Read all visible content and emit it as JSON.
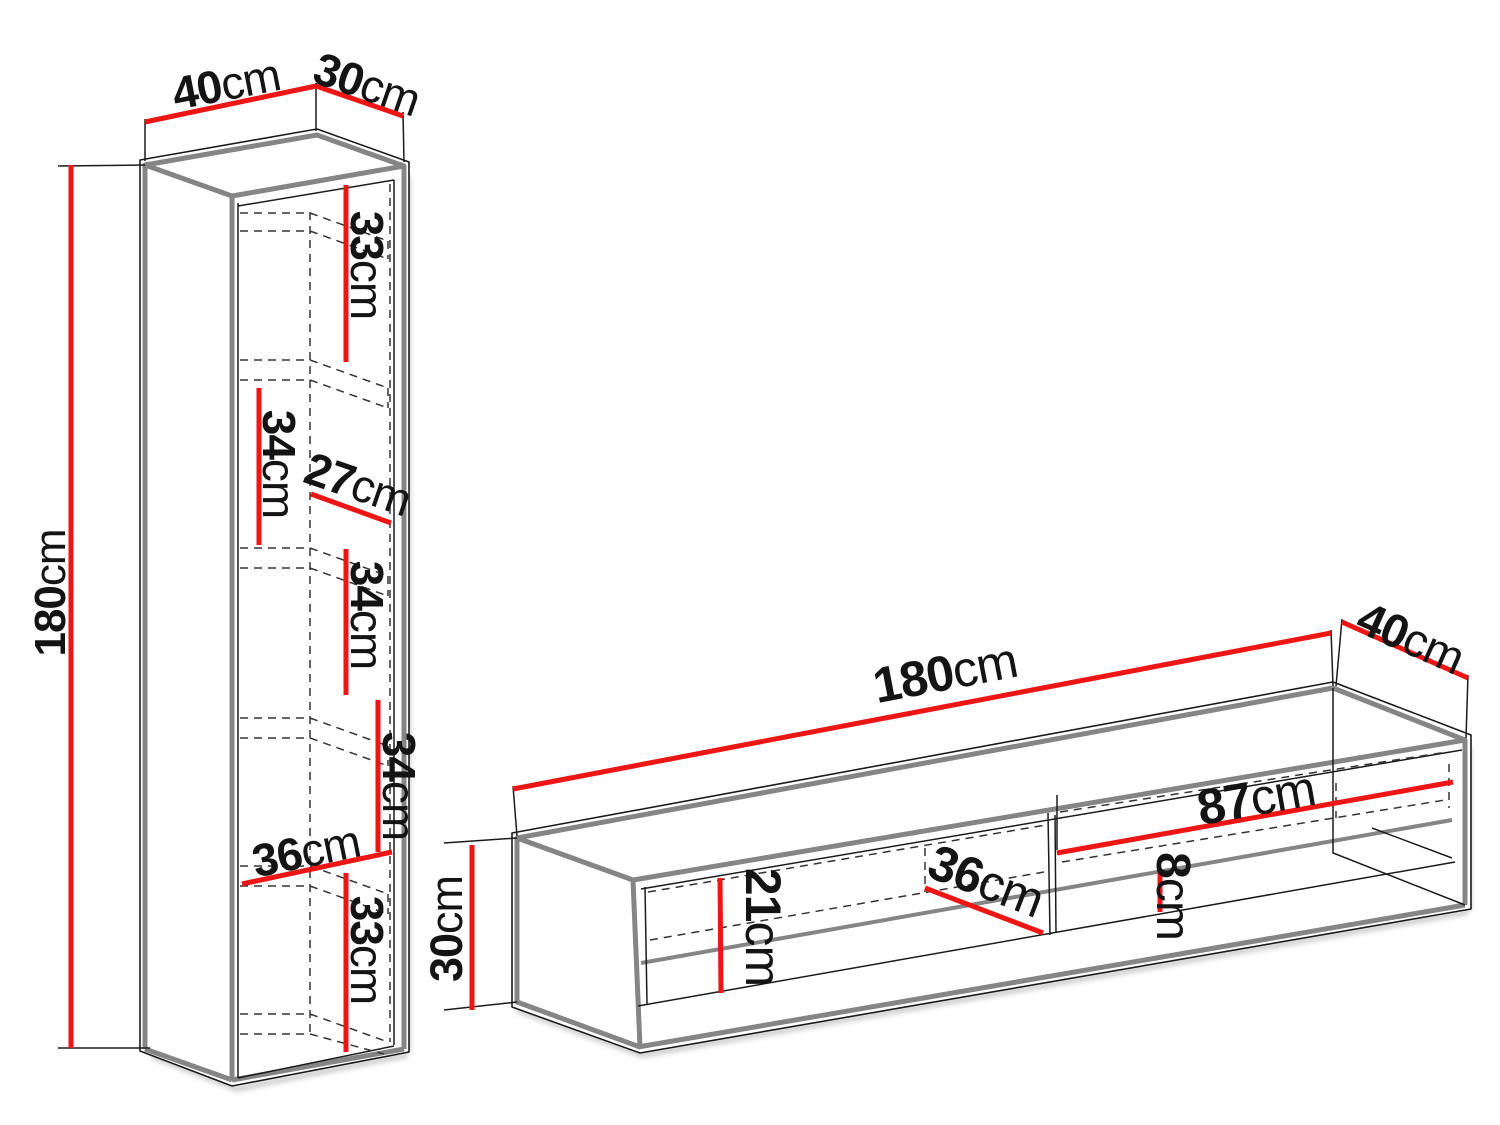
{
  "diagram": {
    "type": "furniture-dimension-drawing",
    "background": "#ffffff",
    "dimension_color": "#ee1515",
    "edge_color": "#858585",
    "outline_color": "#1b1b1b",
    "pieces": [
      {
        "name": "tall wall cabinet",
        "overall": {
          "width": "40cm",
          "depth": "30cm",
          "height": "180cm"
        },
        "internal_dimensions": [
          "33cm",
          "34cm",
          "27cm",
          "34cm",
          "34cm",
          "36cm",
          "33cm"
        ]
      },
      {
        "name": "tv stand",
        "overall": {
          "width": "180cm",
          "depth": "40cm",
          "height": "30cm"
        },
        "internal_dimensions": [
          "21cm",
          "87cm",
          "36cm",
          "8cm"
        ]
      }
    ]
  },
  "labels": {
    "cabinet_width": {
      "value": "40",
      "unit": "cm"
    },
    "cabinet_depth": {
      "value": "30",
      "unit": "cm"
    },
    "cabinet_height": {
      "value": "180",
      "unit": "cm"
    },
    "cabinet_shelf_1": {
      "value": "33",
      "unit": "cm"
    },
    "cabinet_shelf_2": {
      "value": "34",
      "unit": "cm"
    },
    "cabinet_inner_depth": {
      "value": "27",
      "unit": "cm"
    },
    "cabinet_shelf_3": {
      "value": "34",
      "unit": "cm"
    },
    "cabinet_shelf_4": {
      "value": "34",
      "unit": "cm"
    },
    "cabinet_inner_width": {
      "value": "36",
      "unit": "cm"
    },
    "cabinet_shelf_5": {
      "value": "33",
      "unit": "cm"
    },
    "tv_width": {
      "value": "180",
      "unit": "cm"
    },
    "tv_depth": {
      "value": "40",
      "unit": "cm"
    },
    "tv_height": {
      "value": "30",
      "unit": "cm"
    },
    "tv_niche_height": {
      "value": "21",
      "unit": "cm"
    },
    "tv_compartment_width": {
      "value": "87",
      "unit": "cm"
    },
    "tv_inner_depth": {
      "value": "36",
      "unit": "cm"
    },
    "tv_panel_height": {
      "value": "8",
      "unit": "cm"
    }
  }
}
